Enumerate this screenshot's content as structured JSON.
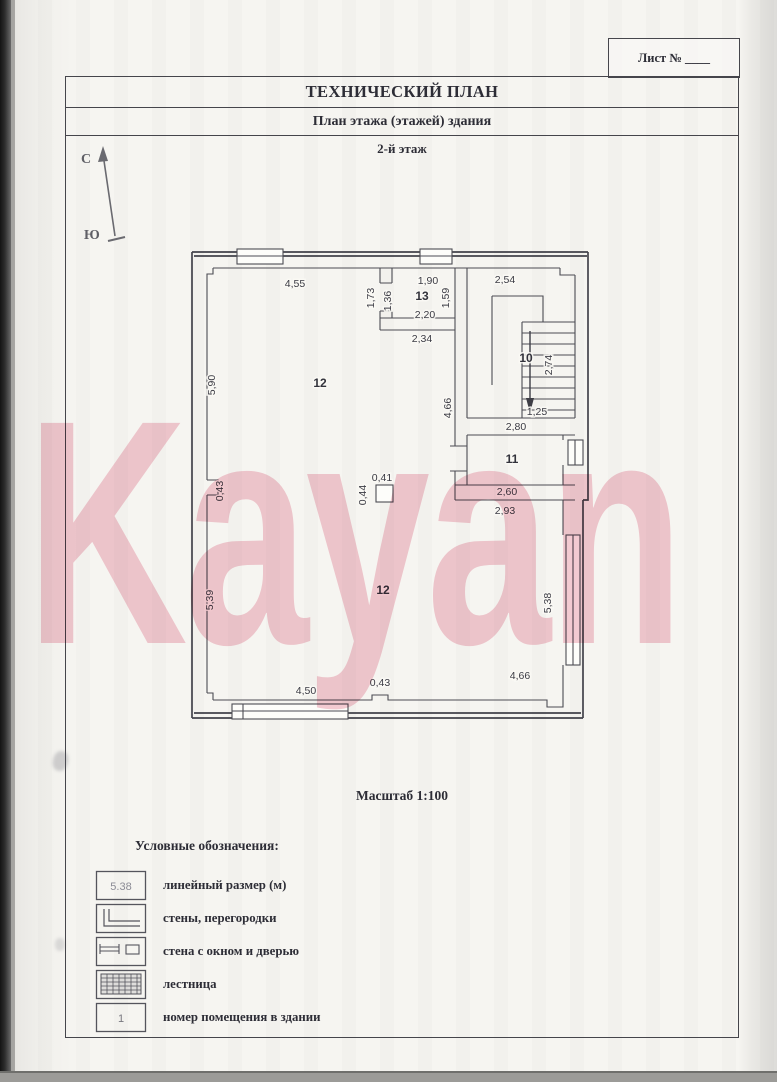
{
  "page": {
    "sheet_label": "Лист № ____",
    "title": "ТЕХНИЧЕСКИЙ ПЛАН",
    "subtitle": "План этажа (этажей) здания",
    "floor_label": "2-й этаж",
    "scale_label": "Масштаб 1:100",
    "watermark_text": "Kayan"
  },
  "compass": {
    "north_label": "С",
    "south_label": "Ю"
  },
  "plan": {
    "room_numbers": {
      "hall_upper": "12",
      "hall_lower": "12",
      "room13": "13",
      "stair10": "10",
      "room11": "11"
    },
    "dims": {
      "top_left": "4,55",
      "top_room13": "1,90",
      "top_stair": "2,54",
      "room13_left_outer": "1,73",
      "room13_left_inner": "1,36",
      "room13_right": "1,59",
      "room13_bottom": "2,20",
      "below_room13": "2,34",
      "left_upper": "5,90",
      "stair_left": "4,66",
      "stair_width": "2,74",
      "stair_flight": "1,25",
      "stair_bottom": "2,80",
      "room11_bottom": "2,60",
      "room11_below": "2,93",
      "left_pilaster": "0,43",
      "column_w": "0,41",
      "column_h": "0,44",
      "left_lower": "5,39",
      "right_lower": "5,38",
      "bottom_left": "4,50",
      "bottom_mid": "0,43",
      "bottom_right": "4,66"
    }
  },
  "legend": {
    "title": "Условные обозначения:",
    "items": [
      {
        "symbol": "dimension-sample",
        "symbol_text": "5.38",
        "label": "линейный размер (м)"
      },
      {
        "symbol": "walls-partitions",
        "symbol_text": "",
        "label": "стены, перегородки"
      },
      {
        "symbol": "wall-window-door",
        "symbol_text": "",
        "label": "стена с окном и дверью"
      },
      {
        "symbol": "stairs",
        "symbol_text": "",
        "label": "лестница"
      },
      {
        "symbol": "room-number",
        "symbol_text": "1",
        "label": "номер помещения в здании"
      }
    ]
  },
  "colors": {
    "paper": "#f6f5f1",
    "ink": "#2d2d36",
    "plan_line": "#4a4a52",
    "watermark_pink": "#f4c3cf"
  }
}
